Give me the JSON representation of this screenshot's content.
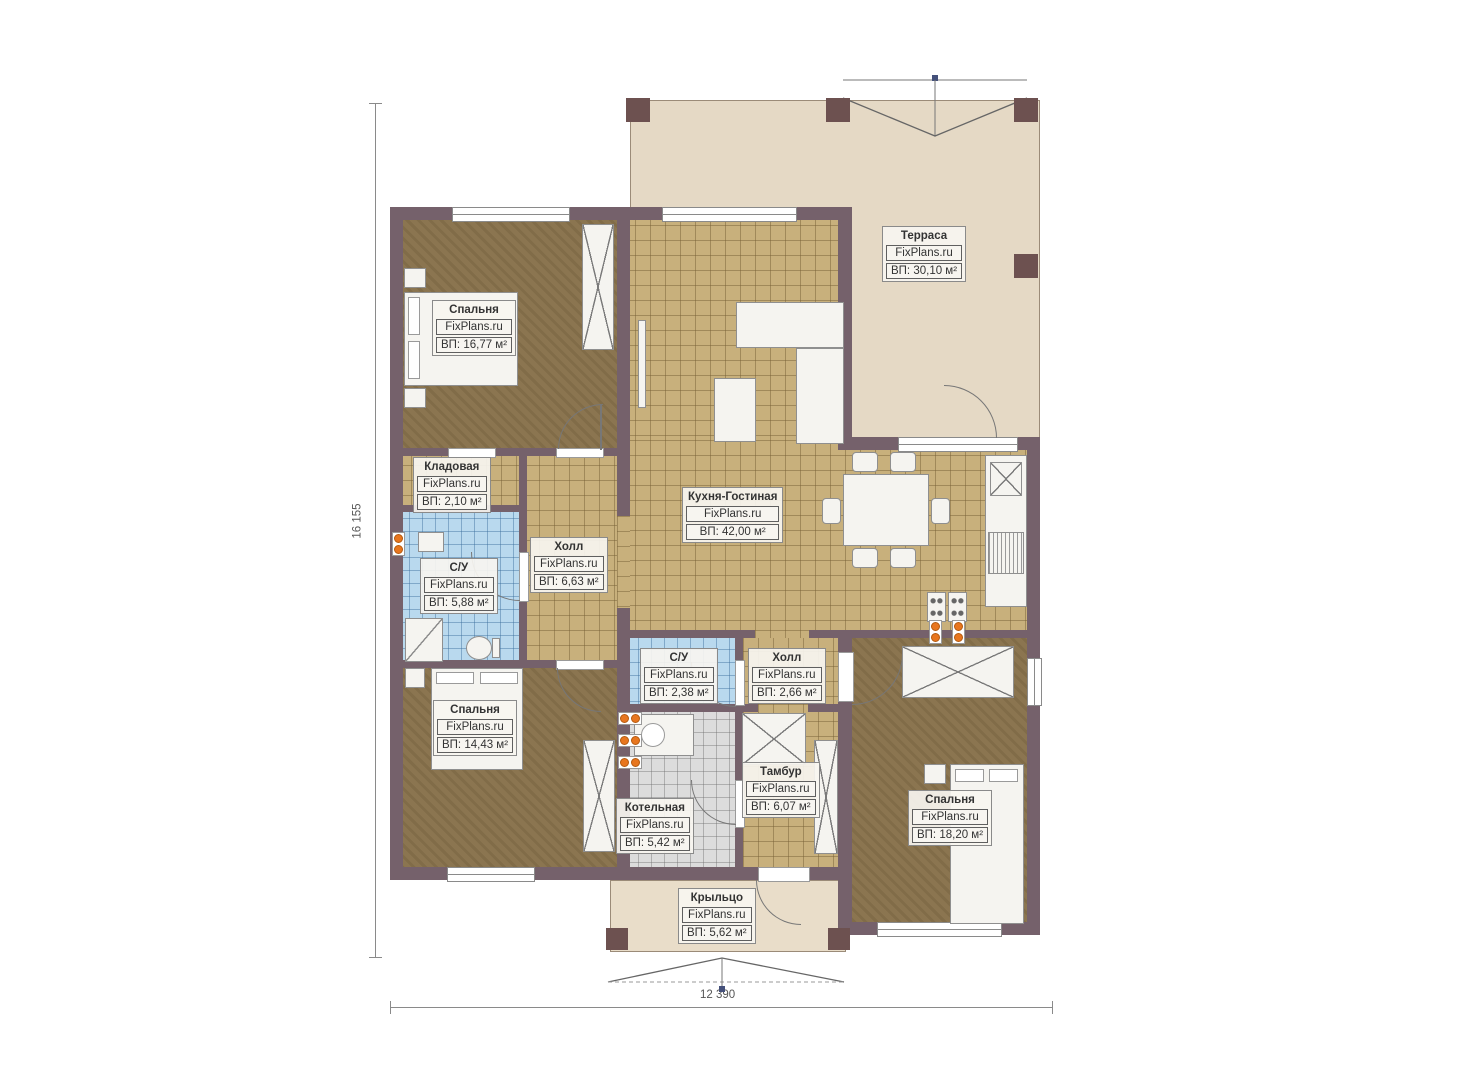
{
  "plan": {
    "watermark": "FixPlans.ru",
    "dimensions": {
      "height_label": "16 155",
      "width_label": "12 390"
    },
    "rooms": [
      {
        "id": "bedroom-1",
        "name": "Спальня",
        "area": "ВП: 16,77 м²"
      },
      {
        "id": "terrace",
        "name": "Терраса",
        "area": "ВП: 30,10 м²"
      },
      {
        "id": "storage",
        "name": "Кладовая",
        "area": "ВП: 2,10 м²"
      },
      {
        "id": "bathroom-1",
        "name": "С/У",
        "area": "ВП: 5,88 м²"
      },
      {
        "id": "hall-1",
        "name": "Холл",
        "area": "ВП: 6,63 м²"
      },
      {
        "id": "kitchen-living",
        "name": "Кухня-Гостиная",
        "area": "ВП: 42,00 м²"
      },
      {
        "id": "bedroom-2",
        "name": "Спальня",
        "area": "ВП: 14,43 м²"
      },
      {
        "id": "bathroom-2",
        "name": "С/У",
        "area": "ВП: 2,38 м²"
      },
      {
        "id": "hall-2",
        "name": "Холл",
        "area": "ВП: 2,66 м²"
      },
      {
        "id": "boiler-room",
        "name": "Котельная",
        "area": "ВП: 5,42 м²"
      },
      {
        "id": "vestibule",
        "name": "Тамбур",
        "area": "ВП: 6,07 м²"
      },
      {
        "id": "bedroom-3",
        "name": "Спальня",
        "area": "ВП: 18,20 м²"
      },
      {
        "id": "porch",
        "name": "Крыльцо",
        "area": "ВП: 5,62 м²"
      }
    ],
    "colors": {
      "wall": "#75616b",
      "pillar": "#6d5150",
      "tile_tan": "#c8b07c",
      "tile_blue": "#b9d9ee",
      "tile_gray": "#dcdcdc",
      "carpet": "#8b7550",
      "terrace": "#e5d9c5",
      "porch": "#e9ddc9",
      "radiator_orange": "#e8761e"
    }
  }
}
